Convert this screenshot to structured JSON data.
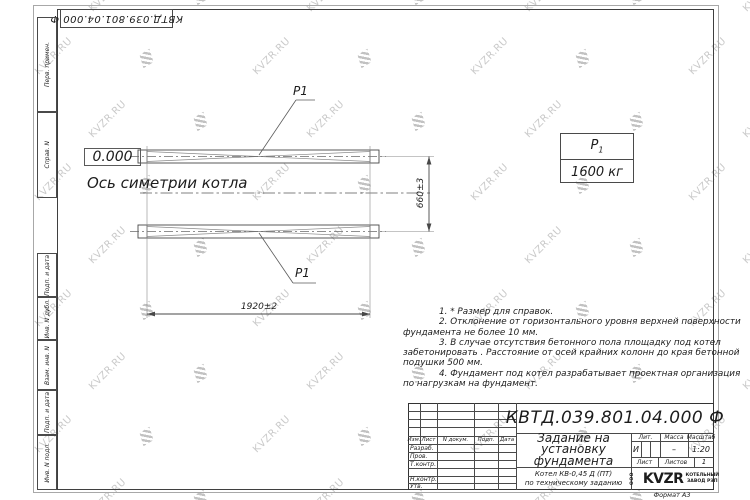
{
  "sheet": {
    "designation_top": "КВТД.039.801.04.000  Ф",
    "format_label": "Формат А3",
    "watermark_text": "KVZR.RU"
  },
  "margin": {
    "group1": {
      "0": "Перв. примен.",
      "1": "Справ. N"
    },
    "group2": {
      "0": "Подп. и дата",
      "1": "Инв. N дубл.",
      "2": "Взам. инв. N",
      "3": "Подп. и дата",
      "4": "Инв. N подл."
    }
  },
  "drawing": {
    "elevation": "0.000",
    "axis_label": "Ось симетрии котла",
    "part_label_top": "P1",
    "part_label_bottom": "P1",
    "dim_width": "1920±2",
    "dim_height": "660±3"
  },
  "load_table": {
    "symbol": "P",
    "symbol_sub": "1",
    "value": "1600 кг"
  },
  "notes": {
    "lines": {
      "0": "1.  * Размер для справок.",
      "1": "2.  Отклонение от горизонтального уровня верхней поверхности",
      "2": "фундамента не более  10  мм.",
      "3": "3.  В случае отсутствия бетонного пола площадку под котел",
      "4": "забетонировать .  Расстояние от осей крайних колонн до края бетонной",
      "5": "подушки  500  мм.",
      "6": "4.  Фундамент под котел разрабатывает проектная организация",
      "7": "по нагрузкам на фундамент."
    }
  },
  "title_block": {
    "designation": "КВТД.039.801.04.000  Ф",
    "title_line1": "Задание на",
    "title_line2": "установку",
    "title_line3": "фундамента",
    "subtitle_line1": "Котел  КВ-0,45  Д  (ПТ)",
    "subtitle_line2": "по техническому заданию",
    "header": {
      "izm": "Изм.",
      "list": "Лист",
      "ndok": "N докум.",
      "podp": "Подп.",
      "data": "Дата"
    },
    "rows": {
      "razrab": "Разраб.",
      "prov": "Пров.",
      "tkontr": "Т.контр.",
      "nkontr": "Н.контр.",
      "utv": "Утв."
    },
    "lit_label": "Лит.",
    "lit_value": "И",
    "massa_label": "Масса",
    "massa_value": "–",
    "scale_label": "Масштаб",
    "scale_value": "1:20",
    "list_label": "Лист",
    "listov_label": "Листов",
    "listov_value": "1",
    "company": {
      "ooo": "ООО",
      "name": "KVZR",
      "desc1": "КОТЕЛЬНЫЙ",
      "desc2": "ЗАВОД РЭП"
    }
  }
}
